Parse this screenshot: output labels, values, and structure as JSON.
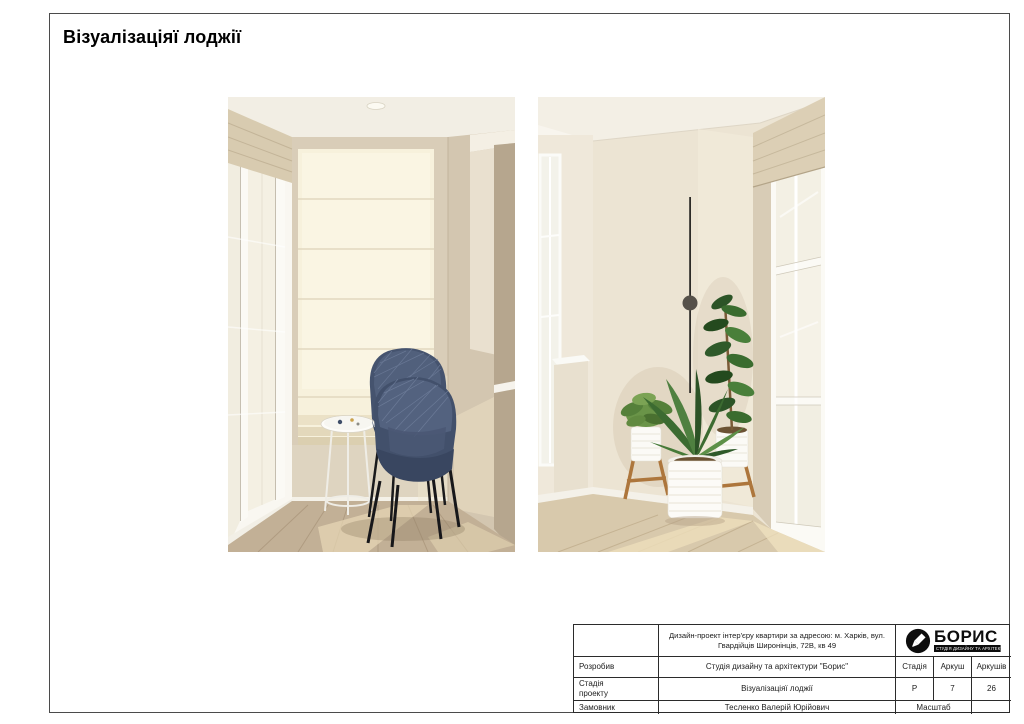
{
  "page": {
    "title": "Візуалізаціяї лоджії"
  },
  "title_block": {
    "project": "Дизайн-проект інтер'єру квартири за адресою: м. Харків, вул. Гвардійців Широнінців, 72В, кв 49",
    "developer_label": "Розробив",
    "developer": "Студія дизайну та архітектури \"Борис\"",
    "stage_label": "Стадія проекту",
    "stage_value": "Візуалізаціяї лоджії",
    "client_label": "Замовник",
    "client": "Тесленко Валерій Юрійович",
    "stadia_header": "Стадія",
    "stadia_value": "Р",
    "sheet_header": "Аркуш",
    "sheet_value": "7",
    "sheets_header": "Аркушів",
    "sheets_value": "26",
    "scale_label": "Масштаб",
    "scale_value": ""
  },
  "logo": {
    "name": "БОРИС",
    "tagline": "СТУДІЯ ДИЗАЙНУ ТА АРХІТЕКТУРИ",
    "icon": "marker-in-circle-icon"
  },
  "colors": {
    "frame": "#4b4b4b",
    "table_border": "#2b2b2b",
    "wall_beige": "#d9cdb8",
    "wall_cream": "#ece4d3",
    "shade_cream": "#f7f1dc",
    "chair_navy": "#42506b",
    "floor_wood": "#c2b096",
    "plant_green": "#3c6b31",
    "wood_stand": "#ad763c",
    "logo_black": "#0d0d0d"
  }
}
